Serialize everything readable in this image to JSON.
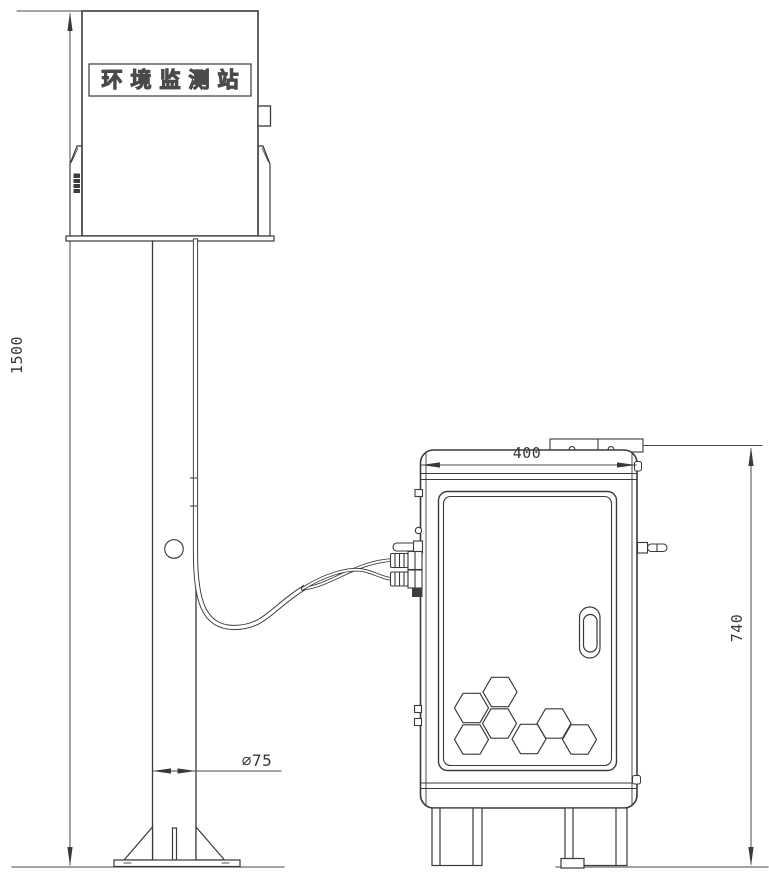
{
  "drawing_title": "environmental monitoring station installation drawing",
  "station": {
    "label": "环境监测站"
  },
  "dimensions": {
    "pole_height": "1500",
    "pole_diameter": "∅75",
    "cabinet_width": "400",
    "cabinet_height": "740"
  },
  "colors": {
    "background": "#ffffff",
    "line": "#3a3a3a",
    "dim_line": "#4a4a4a",
    "ground": "#6a6a6a"
  }
}
